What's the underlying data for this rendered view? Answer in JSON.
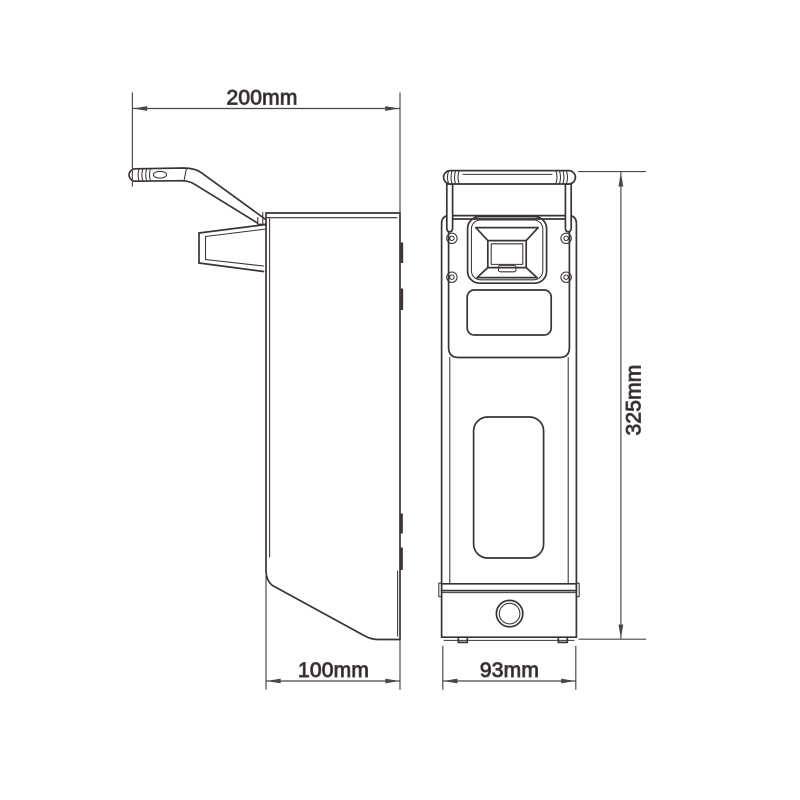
{
  "drawing": {
    "background": "#ffffff",
    "line_color": "#3a3433",
    "dimension_line_color": "#4c4644",
    "text_color": "#231f20",
    "dimensions": {
      "top_width": "200mm",
      "bottom_depth": "100mm",
      "front_width": "93mm",
      "height": "325mm"
    }
  }
}
